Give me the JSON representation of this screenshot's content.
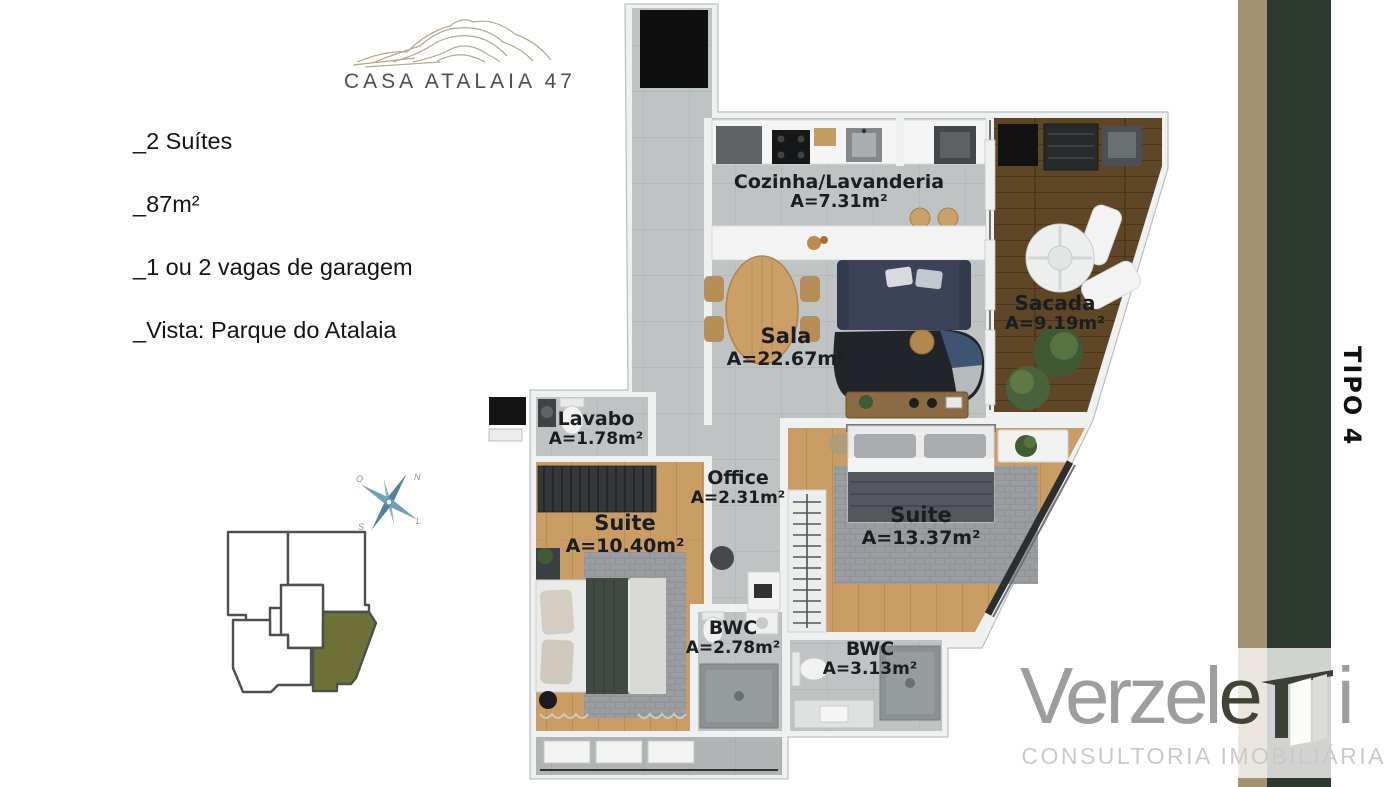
{
  "brand": {
    "logo_title": "CASA ATALAIA 47"
  },
  "features": [
    "_2 Suítes",
    "_87m²",
    "_1 ou 2 vagas de garagem",
    "_Vista: Parque do Atalaia"
  ],
  "compass": {
    "north": "N",
    "east": "L",
    "south": "S",
    "west": "O"
  },
  "side_label": "TIPO 4",
  "rooms": [
    {
      "name": "Cozinha/Lavanderia",
      "area": "A=7.31m²"
    },
    {
      "name": "Sala",
      "area": "A=22.67m²"
    },
    {
      "name": "Sacada",
      "area": "A=9.19m²"
    },
    {
      "name": "Lavabo",
      "area": "A=1.78m²"
    },
    {
      "name": "Office",
      "area": "A=2.31m²"
    },
    {
      "name": "Suite",
      "area": "A=10.40m²"
    },
    {
      "name": "Suite",
      "area": "A=13.37m²"
    },
    {
      "name": "BWC",
      "area": "A=2.78m²"
    },
    {
      "name": "BWC",
      "area": "A=3.13m²"
    }
  ],
  "footer": {
    "brand_part1": "Verzel",
    "brand_part2": "e",
    "brand_part3": "i",
    "subtitle": "CONSULTORIA IMOBILIÁRIA"
  },
  "colors": {
    "accent_olive": "#6d7138",
    "stripe_tan": "#a39272",
    "stripe_green": "#2d392e",
    "wood_light": "#c99d64",
    "wood_dark": "#5e4627",
    "tile_gray": "#bfc3c3"
  }
}
